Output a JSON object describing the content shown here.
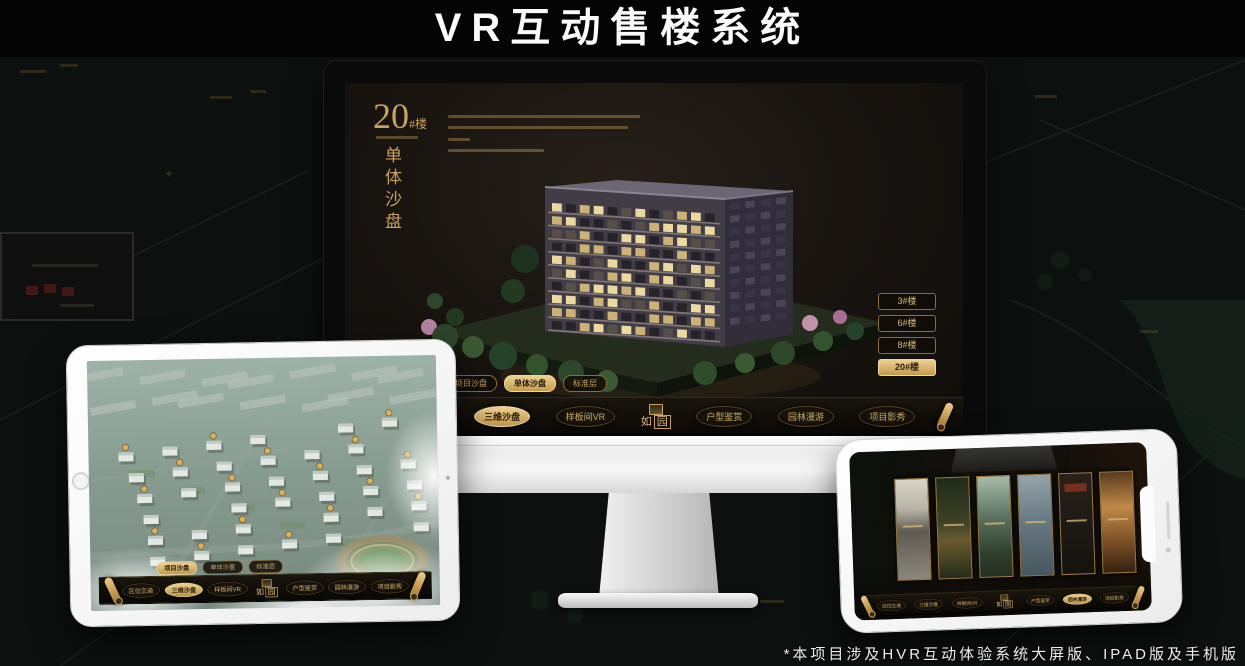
{
  "page": {
    "title": "VR互动售楼系统",
    "footnote": "*本项目涉及HVR互动体验系统大屏版、IPAD版及手机版"
  },
  "brand": {
    "name": "如园",
    "char_left": "如",
    "char_right": "园"
  },
  "monitor_app": {
    "heading": {
      "number": "20",
      "suffix": "#楼",
      "subtitle": "单体沙盘"
    },
    "floor_buttons": [
      {
        "label": "3#楼",
        "active": false
      },
      {
        "label": "6#楼",
        "active": false
      },
      {
        "label": "8#楼",
        "active": false
      },
      {
        "label": "20#楼",
        "active": true
      }
    ],
    "view_tabs": [
      {
        "label": "项目沙盘",
        "active": false
      },
      {
        "label": "单体沙盘",
        "active": true
      },
      {
        "label": "标准层",
        "active": false
      }
    ],
    "nav_items": [
      {
        "label": "区位交通",
        "active": false
      },
      {
        "label": "三维沙盘",
        "active": true
      },
      {
        "label": "样板间VR",
        "active": false
      },
      {
        "label": "户型鉴赏",
        "active": false
      },
      {
        "label": "园林漫游",
        "active": false
      },
      {
        "label": "项目影秀",
        "active": false
      }
    ]
  },
  "ipad_app": {
    "view_tabs": [
      {
        "label": "项目沙盘",
        "active": true
      },
      {
        "label": "单体沙盘",
        "active": false
      },
      {
        "label": "标准层",
        "active": false
      }
    ],
    "nav_items": [
      {
        "label": "区位交通",
        "active": false
      },
      {
        "label": "三维沙盘",
        "active": true
      },
      {
        "label": "样板间VR",
        "active": false
      },
      {
        "label": "户型鉴赏",
        "active": false
      },
      {
        "label": "园林漫游",
        "active": false
      },
      {
        "label": "项目影秀",
        "active": false
      }
    ]
  },
  "phone_app": {
    "nav_items": [
      {
        "label": "区位交通",
        "active": false
      },
      {
        "label": "三维沙盘",
        "active": false
      },
      {
        "label": "样板间VR",
        "active": false
      },
      {
        "label": "户型鉴赏",
        "active": false
      },
      {
        "label": "园林漫游",
        "active": true
      },
      {
        "label": "项目影秀",
        "active": false
      }
    ]
  },
  "colors": {
    "gold": "#c9a25e",
    "gold_bright": "#ecd092",
    "screen_brown": "#1a1511",
    "device_white": "#f5f5f5",
    "page_bg": "#0c100e",
    "active_text": "#271c0b"
  }
}
